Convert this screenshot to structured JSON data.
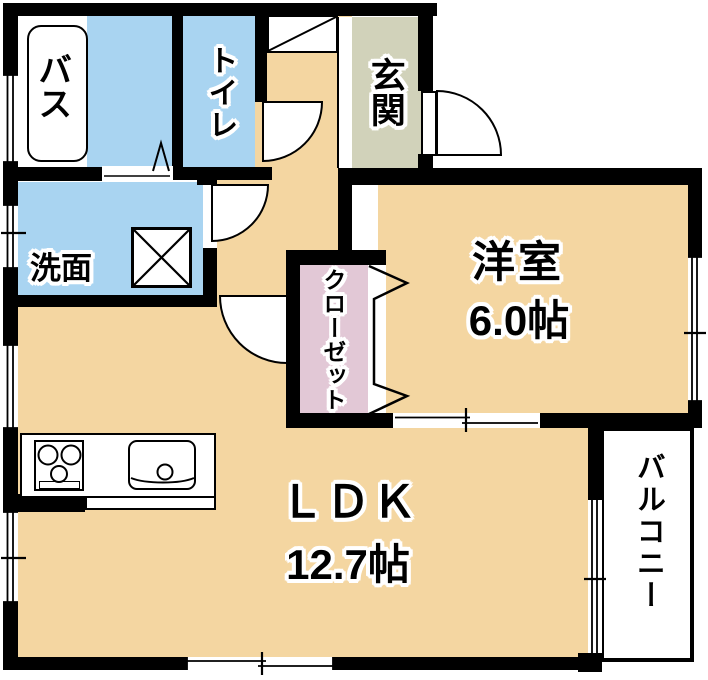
{
  "rooms": {
    "bath": {
      "label": "バス"
    },
    "toilet": {
      "label": "トイレ"
    },
    "entrance": {
      "label": "玄関"
    },
    "washroom": {
      "label": "洗面"
    },
    "closet": {
      "label": "クローゼット"
    },
    "western_room": {
      "label": "洋室",
      "size": "6.0帖"
    },
    "ldk": {
      "label": "ＬＤＫ",
      "size": "12.7帖"
    },
    "balcony": {
      "label": "バルコニー"
    }
  },
  "fixtures": {
    "bathtub": "bathtub",
    "washing_machine": "washing-machine-pan",
    "stove": "three-burner-stove",
    "sink": "kitchen-sink",
    "shoe_cabinet": "shoe-cabinet"
  },
  "colors": {
    "floor": "#F4D6A1",
    "wet_area": "#A9D4F1",
    "entrance_floor": "#D1D2BA",
    "closet_floor": "#E2C8D6",
    "wall": "#000000",
    "fixture": "#FFFFFF"
  }
}
